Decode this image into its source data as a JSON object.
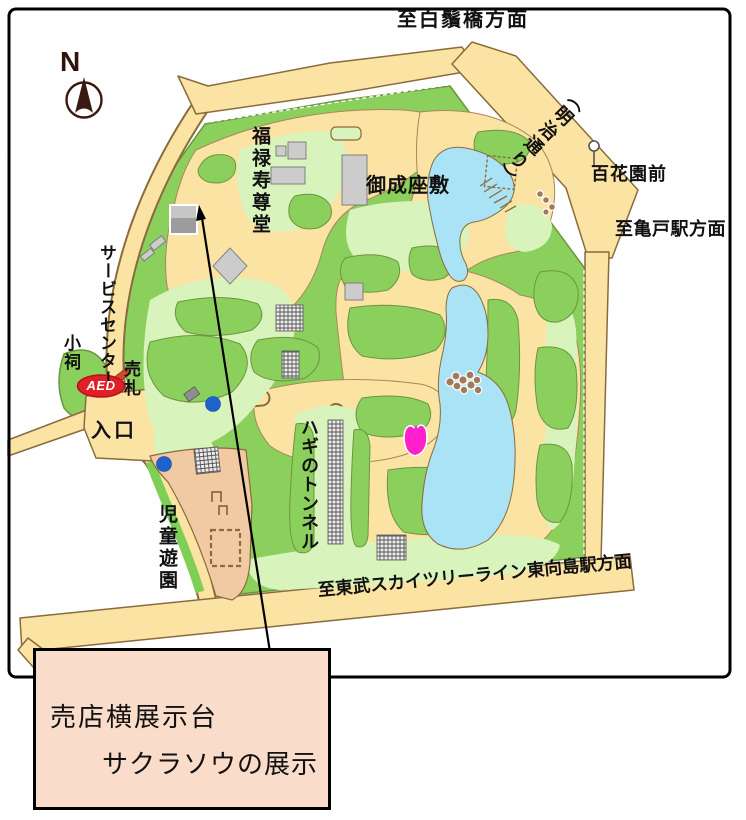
{
  "compass": {
    "label": "N"
  },
  "roads": {
    "top_destination": "至白鬚橋方面",
    "meiji_street": "（明治通り）",
    "kameido": "至亀戸駅方面",
    "bottom_destination": "至東武スカイツリーライン東向島駅方面"
  },
  "bus_stop": {
    "name": "百花園前"
  },
  "places": {
    "fukurokuju_hall": "福禄寿尊堂",
    "onari_zashiki": "御成座敷",
    "service_center": "サービスセンター",
    "small_shrine": "小祠",
    "ticket_booth": "売札",
    "aed": "AED",
    "entrance": "入口",
    "hagi_tunnel": "ハギのトンネル",
    "childrens_playground": "児童遊園"
  },
  "annotation": {
    "line1": "売店横展示台",
    "line2": "サクラソウの展示"
  },
  "colors": {
    "road": "#fbe3a4",
    "park_green": "#8bd05c",
    "lawn_green": "#d8f4bc",
    "pond_blue": "#abe3f6",
    "playground_tan": "#f1c9a2",
    "building_gray": "#cccccc",
    "tulip_pink": "#ff22cc",
    "marker_blue": "#1e63cc",
    "aed_red": "#e11f26",
    "annotation_bg": "#fadccb"
  }
}
